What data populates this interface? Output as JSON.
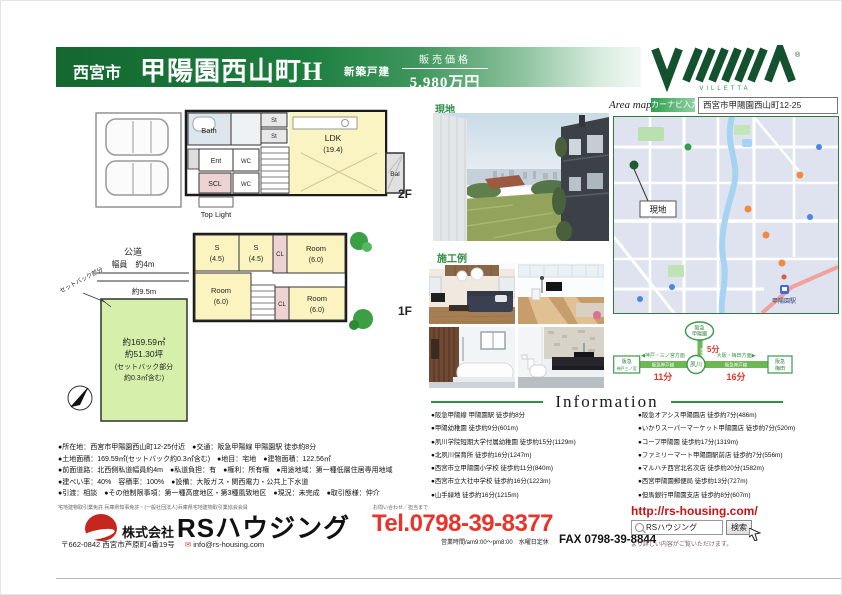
{
  "header": {
    "city": "西宮市",
    "name": "甲陽園西山町H",
    "badge": "新築戸建",
    "price_label": "販売価格",
    "price": "5,980万円"
  },
  "brand": {
    "mark": "VIIIIIIA",
    "sub": "VILLETTA",
    "registered": "®"
  },
  "area_map": {
    "label": "Area map",
    "navi_badge": "カーナビ入力",
    "navi_address": "西宮市甲陽園西山町12-25"
  },
  "map": {
    "site_pin": "現地",
    "station": "甲陽園駅"
  },
  "route": {
    "top1": "阪急",
    "top2": "甲陽園",
    "center": "夙川",
    "left1": "阪急",
    "left2": "神戸三ノ宮",
    "right1": "阪急",
    "right2": "梅田",
    "v_line": "阪急甲陽線",
    "h_line_left": "阪急神戸線",
    "h_line_right": "阪急神戸線",
    "dir_left": "◀神戸・三ノ宮方面",
    "dir_right": "大阪・梅田方面▶",
    "t_top": "5分",
    "t_left": "11分",
    "t_right": "16分"
  },
  "plan2f": {
    "floor": "2F",
    "bath": "Bath",
    "ent": "Ent",
    "scl": "SCL",
    "wc1": "WC",
    "wc2": "WC",
    "st1": "St",
    "st2": "St",
    "ldk": "LDK",
    "ldk_size": "(19.4)",
    "bal": "Bal",
    "toplight": "Top Light"
  },
  "plan1f": {
    "floor": "1F",
    "s1": "S",
    "s1_size": "(4.5)",
    "s2": "S",
    "s2_size": "(4.5)",
    "cl1": "CL",
    "cl2": "CL",
    "room1": "Room",
    "room1_size": "(6.0)",
    "room2": "Room",
    "room2_size": "(6.0)",
    "room3": "Room",
    "room3_size": "(6.0)"
  },
  "siteplan": {
    "road": "公道",
    "road_width": "幅員　約4m",
    "frontage": "約9.5m",
    "area1": "約169.59㎡",
    "area2": "約51.30坪",
    "area3": "(セットバック部分",
    "area4": "約0.3㎡含む)",
    "setback": "セットバック部分"
  },
  "photos": {
    "site_label": "現地",
    "works_label": "施工例"
  },
  "details": [
    "●所在地：西宮市甲陽園西山町12-25付近　●交通：阪急甲陽線 甲陽園駅 徒歩約8分",
    "●土地面積：169.59㎡(セットバック約0.3㎡含む)　●地目：宅地　●建物面積：122.56㎡",
    "●前面道路：北西側私道幅員約4m　●私道負担：有　●権利：所有権　●用途地域：第一種低層住居専用地域",
    "●建ぺい率：40%　容積率：100%　●設備：大阪ガス・関西電力・公共上下水道",
    "●引渡：相談　●その他制限事項：第一種高度地区・第3種風致地区　●現況：未完成　●取引態様：仲介"
  ],
  "information": {
    "title": "Information",
    "left": [
      "●阪急甲陽線 甲陽園駅 徒歩約8分",
      "●甲陽幼稚園 徒歩約9分(601m)",
      "●夙川学院短期大学付属幼稚園 徒歩約15分(1129m)",
      "●北夙川保育所 徒歩約16分(1247m)",
      "●西宮市立甲陽園小学校 徒歩約11分(840m)",
      "●西宮市立大社中学校 徒歩約16分(1223m)",
      "●山手緑地 徒歩約16分(1215m)"
    ],
    "right": [
      "●阪急オアシス甲陽園店 徒歩約7分(486m)",
      "●いかりスーパーマーケット甲陽園店 徒歩約7分(520m)",
      "●コープ甲陽園 徒歩約17分(1319m)",
      "●ファミリーマート甲陽園駅前店 徒歩約7分(556m)",
      "●マルハチ西宮北名次店 徒歩約20分(1582m)",
      "●西宮甲陽園郵便局 徒歩約13分(727m)",
      "●但馬銀行甲陽園支店 徒歩約8分(607m)"
    ]
  },
  "footer": {
    "license": "宅地建物取引業免許 兵庫県知事免許・(一般社団法人)兵庫県宅地建物取引業協会会員",
    "inquiry": "お問い合わせ／担当まで",
    "company_type": "株式会社",
    "company": "RSハウジング",
    "address": "〒662-0842 西宮市芦原町4番19号",
    "email": "info@rs-housing.com",
    "tel": "Tel.0798-39-8377",
    "hours": "営業時間/am9:00～pm8:00　水曜日定休",
    "fax": "FAX 0798-39-8844",
    "url": "http://rs-housing.com/",
    "search_value": "RSハウジング",
    "search_button": "検索",
    "search_note": "より詳しい内容がご覧いただけます。"
  },
  "colors": {
    "brand_green": "#1b7a3c",
    "accent_red": "#e8342a"
  }
}
